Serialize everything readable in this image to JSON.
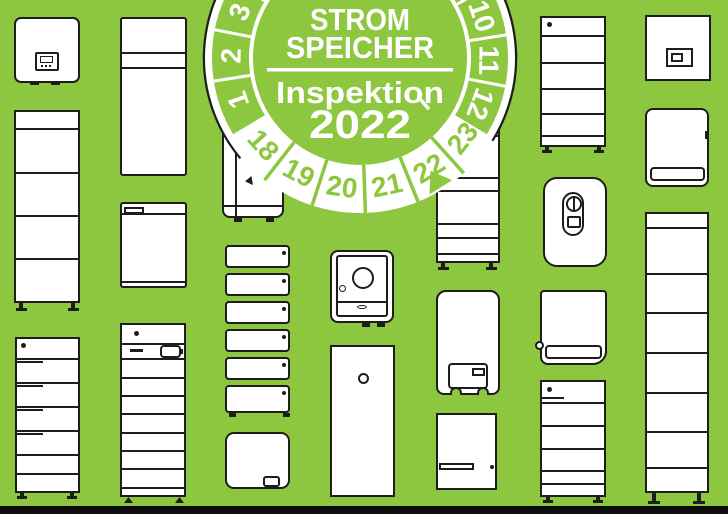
{
  "page": {
    "background_color": "#8dc63f",
    "bottom_bar_color": "#0d0d0d"
  },
  "badge": {
    "title_line1": "STROM",
    "title_line2": "SPEICHER",
    "subtitle": "Inspektion",
    "year": "2022",
    "month_numbers": [
      "1",
      "2",
      "3",
      "10",
      "11",
      "12"
    ],
    "year_numbers": [
      "18",
      "19",
      "20",
      "21",
      "22",
      "23"
    ],
    "marked_year": "22",
    "green": "#8dc63f",
    "white": "#ffffff",
    "outline": "#1d1d1b"
  },
  "illustrations": [
    "solar-inverter",
    "battery-cabinet-4-module",
    "battery-tower-vented",
    "slim-storage-cabinet",
    "wall-unit-with-tab",
    "battery-rack-8-module",
    "floor-unit-behind-badge",
    "stackable-battery-modules",
    "wallbox-charger",
    "compact-storage-with-dial",
    "slim-tower-unit",
    "segmented-battery-tower",
    "storage-with-display",
    "vented-wall-box",
    "battery-tower-with-led",
    "round-storage-with-control",
    "cabinet-with-slot",
    "battery-tower-small",
    "inverter-with-display",
    "wall-storage-with-vent",
    "tall-battery-tower"
  ]
}
